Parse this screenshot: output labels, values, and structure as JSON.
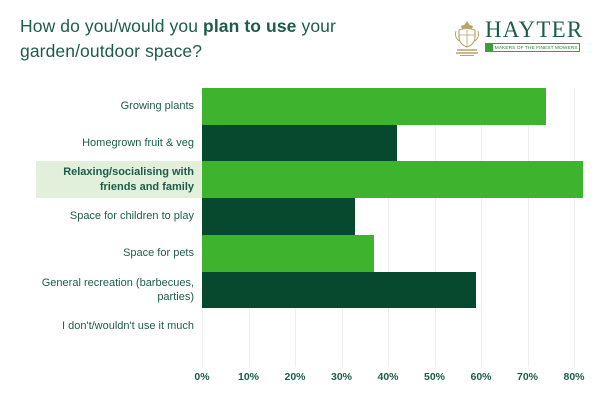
{
  "title": {
    "prefix": "How do you/would you ",
    "bold": "plan to use",
    "suffix": " your garden/outdoor space?"
  },
  "logo": {
    "name": "HAYTER",
    "tagline": "MAKERS OF THE FINEST MOWERS"
  },
  "colors": {
    "bar_light_green": "#3db32e",
    "bar_dark_green": "#06492f",
    "title_green": "#1d5c4b",
    "highlight_background": "#e2efda",
    "gridline": "#edf1ec",
    "logo_gold": "#b9a26b"
  },
  "chart_data": {
    "type": "bar",
    "orientation": "horizontal",
    "title": "How do you/would you plan to use your garden/outdoor space?",
    "categories": [
      "Growing plants",
      "Homegrown fruit & veg",
      "Relaxing/socialising with friends and family",
      "Space for children to play",
      "Space for pets",
      "General recreation (barbecues, parties)",
      "I don't/wouldn't use it much"
    ],
    "values": [
      74,
      42,
      82,
      33,
      37,
      59,
      0
    ],
    "row_colors": [
      "light",
      "dark",
      "light",
      "dark",
      "light",
      "dark",
      "light"
    ],
    "bar_palette": {
      "light": "#3db32e",
      "dark": "#06492f"
    },
    "highlight_index": 2,
    "xlim": [
      0,
      80
    ],
    "x_tick_labels": [
      "0%",
      "10%",
      "20%",
      "30%",
      "40%",
      "50%",
      "60%",
      "70%",
      "80%"
    ],
    "grid": true,
    "legend": "none"
  }
}
